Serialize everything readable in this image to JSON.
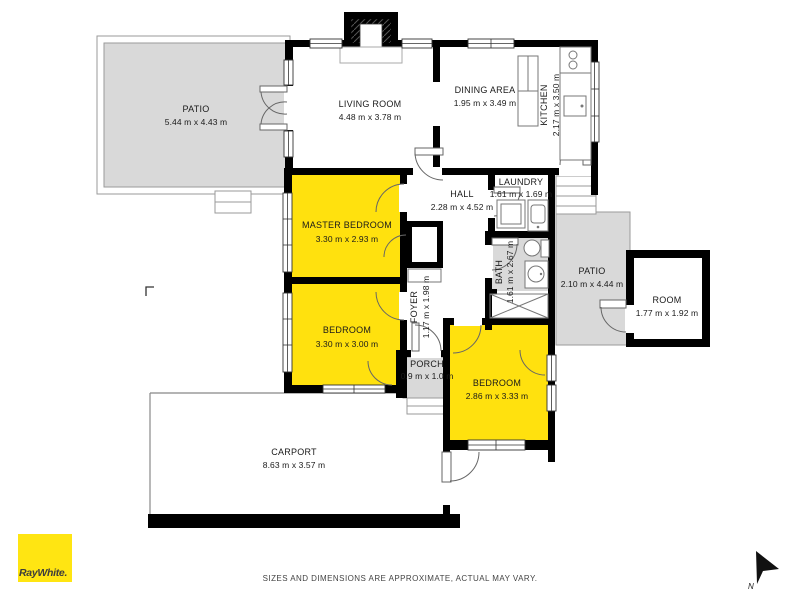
{
  "meta": {
    "type": "floor-plan",
    "agency_branding": true
  },
  "colors": {
    "room_highlight": "#ffe10e",
    "outdoor_area": "#d9d9d9",
    "wall": "#000000",
    "brand_yellow": "#ffe512"
  },
  "rooms": [
    {
      "id": "patio-top",
      "name": "PATIO",
      "dims": "5.44 m x 4.43 m",
      "type": "outdoor"
    },
    {
      "id": "living-room",
      "name": "LIVING ROOM",
      "dims": "4.48 m x 3.78 m",
      "type": "interior"
    },
    {
      "id": "dining-area",
      "name": "DINING AREA",
      "dims": "1.95 m x 3.49 m",
      "type": "interior"
    },
    {
      "id": "kitchen",
      "name": "KITCHEN",
      "dims": "2.17 m x 3.50 m",
      "type": "interior",
      "label_rotated": true
    },
    {
      "id": "hall",
      "name": "HALL",
      "dims": "2.28 m x 4.52 m",
      "type": "interior"
    },
    {
      "id": "laundry",
      "name": "LAUNDRY",
      "dims": "1.61 m x 1.69 m",
      "type": "interior"
    },
    {
      "id": "master-bedroom",
      "name": "MASTER BEDROOM",
      "dims": "3.30 m x 2.93 m",
      "type": "highlight"
    },
    {
      "id": "bedroom-left",
      "name": "BEDROOM",
      "dims": "3.30 m x 3.00 m",
      "type": "highlight"
    },
    {
      "id": "foyer",
      "name": "FOYER",
      "dims": "1.17 m x 1.98 m",
      "type": "interior",
      "label_rotated": true
    },
    {
      "id": "bath",
      "name": "BATH",
      "dims": "1.61 m x 2.67 m",
      "type": "interior",
      "label_rotated": true
    },
    {
      "id": "porch",
      "name": "PORCH",
      "dims": "0.9 m x 1.0 m",
      "type": "outdoor"
    },
    {
      "id": "patio-right",
      "name": "PATIO",
      "dims": "2.10 m x 4.44 m",
      "type": "outdoor"
    },
    {
      "id": "room-detached",
      "name": "ROOM",
      "dims": "1.77 m x 1.92 m",
      "type": "interior"
    },
    {
      "id": "bedroom-bottom",
      "name": "BEDROOM",
      "dims": "2.86 m x 3.33 m",
      "type": "highlight"
    },
    {
      "id": "carport",
      "name": "CARPORT",
      "dims": "8.63 m x 3.57 m",
      "type": "interior"
    }
  ],
  "footer": {
    "disclaimer": "SIZES AND DIMENSIONS ARE APPROXIMATE, ACTUAL MAY VARY.",
    "brand": "RayWhite.",
    "north": "N"
  }
}
